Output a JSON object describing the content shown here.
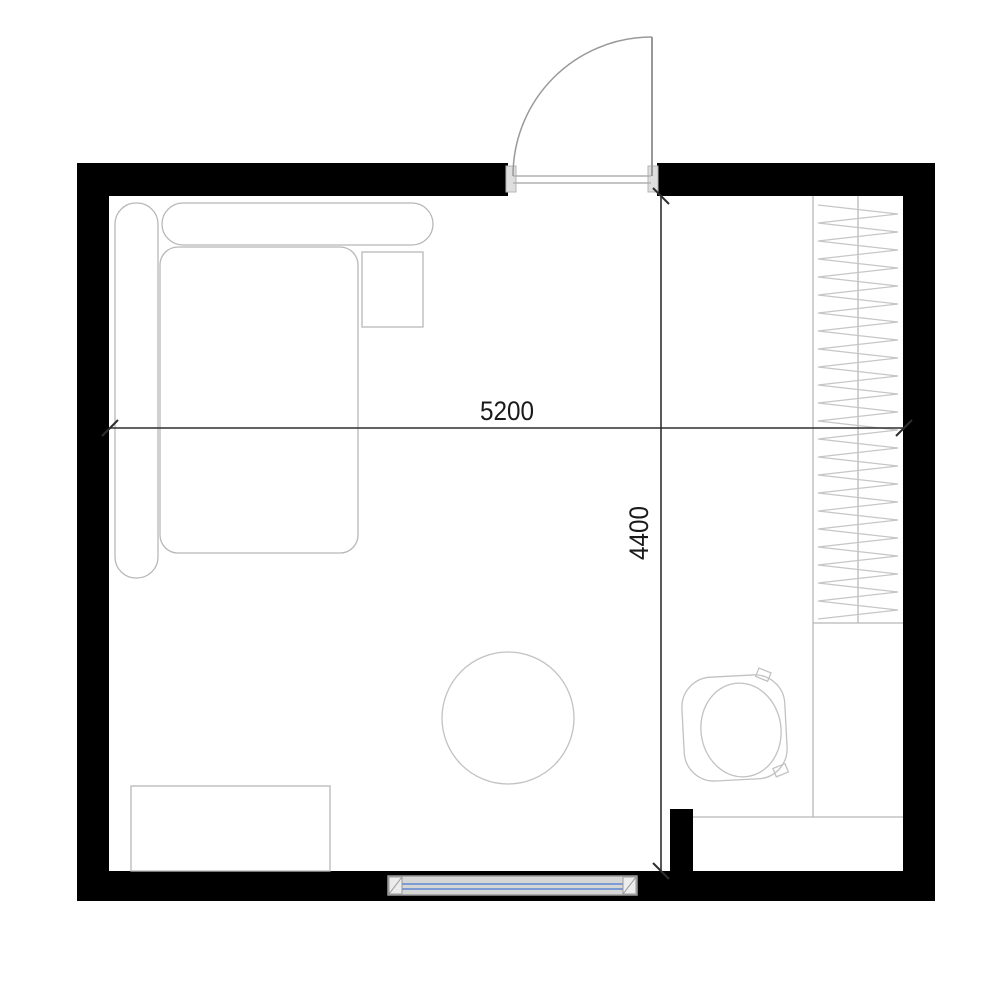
{
  "drawing": {
    "kind": "floor-plan",
    "room": "studio-room",
    "dimensions": {
      "width_label": "5200",
      "height_label": "4400"
    },
    "elements": [
      "exterior-walls",
      "entry-door-with-swing",
      "door-threshold",
      "sofa-with-armrest-and-backrest",
      "side-table",
      "round-rug",
      "dresser",
      "window-in-bottom-wall",
      "wardrobe-with-hanging-clothes",
      "lower-cabinet-counter",
      "toilet",
      "partition-wall-stub",
      "horizontal-dimension-line",
      "vertical-dimension-line"
    ],
    "colors": {
      "wall": "#000000",
      "furniture_line": "#b8b8b8",
      "hatch_line": "#c6c6c6",
      "dimension_line": "#2e2e2e",
      "dimension_text": "#1a1a1a",
      "door_line": "#999999",
      "threshold_line": "#b0b0b0",
      "window_frame": "#9a9a9a",
      "window_fill": "#d6d6d6",
      "window_glass": "#7b9bd2",
      "background": "#ffffff"
    }
  }
}
